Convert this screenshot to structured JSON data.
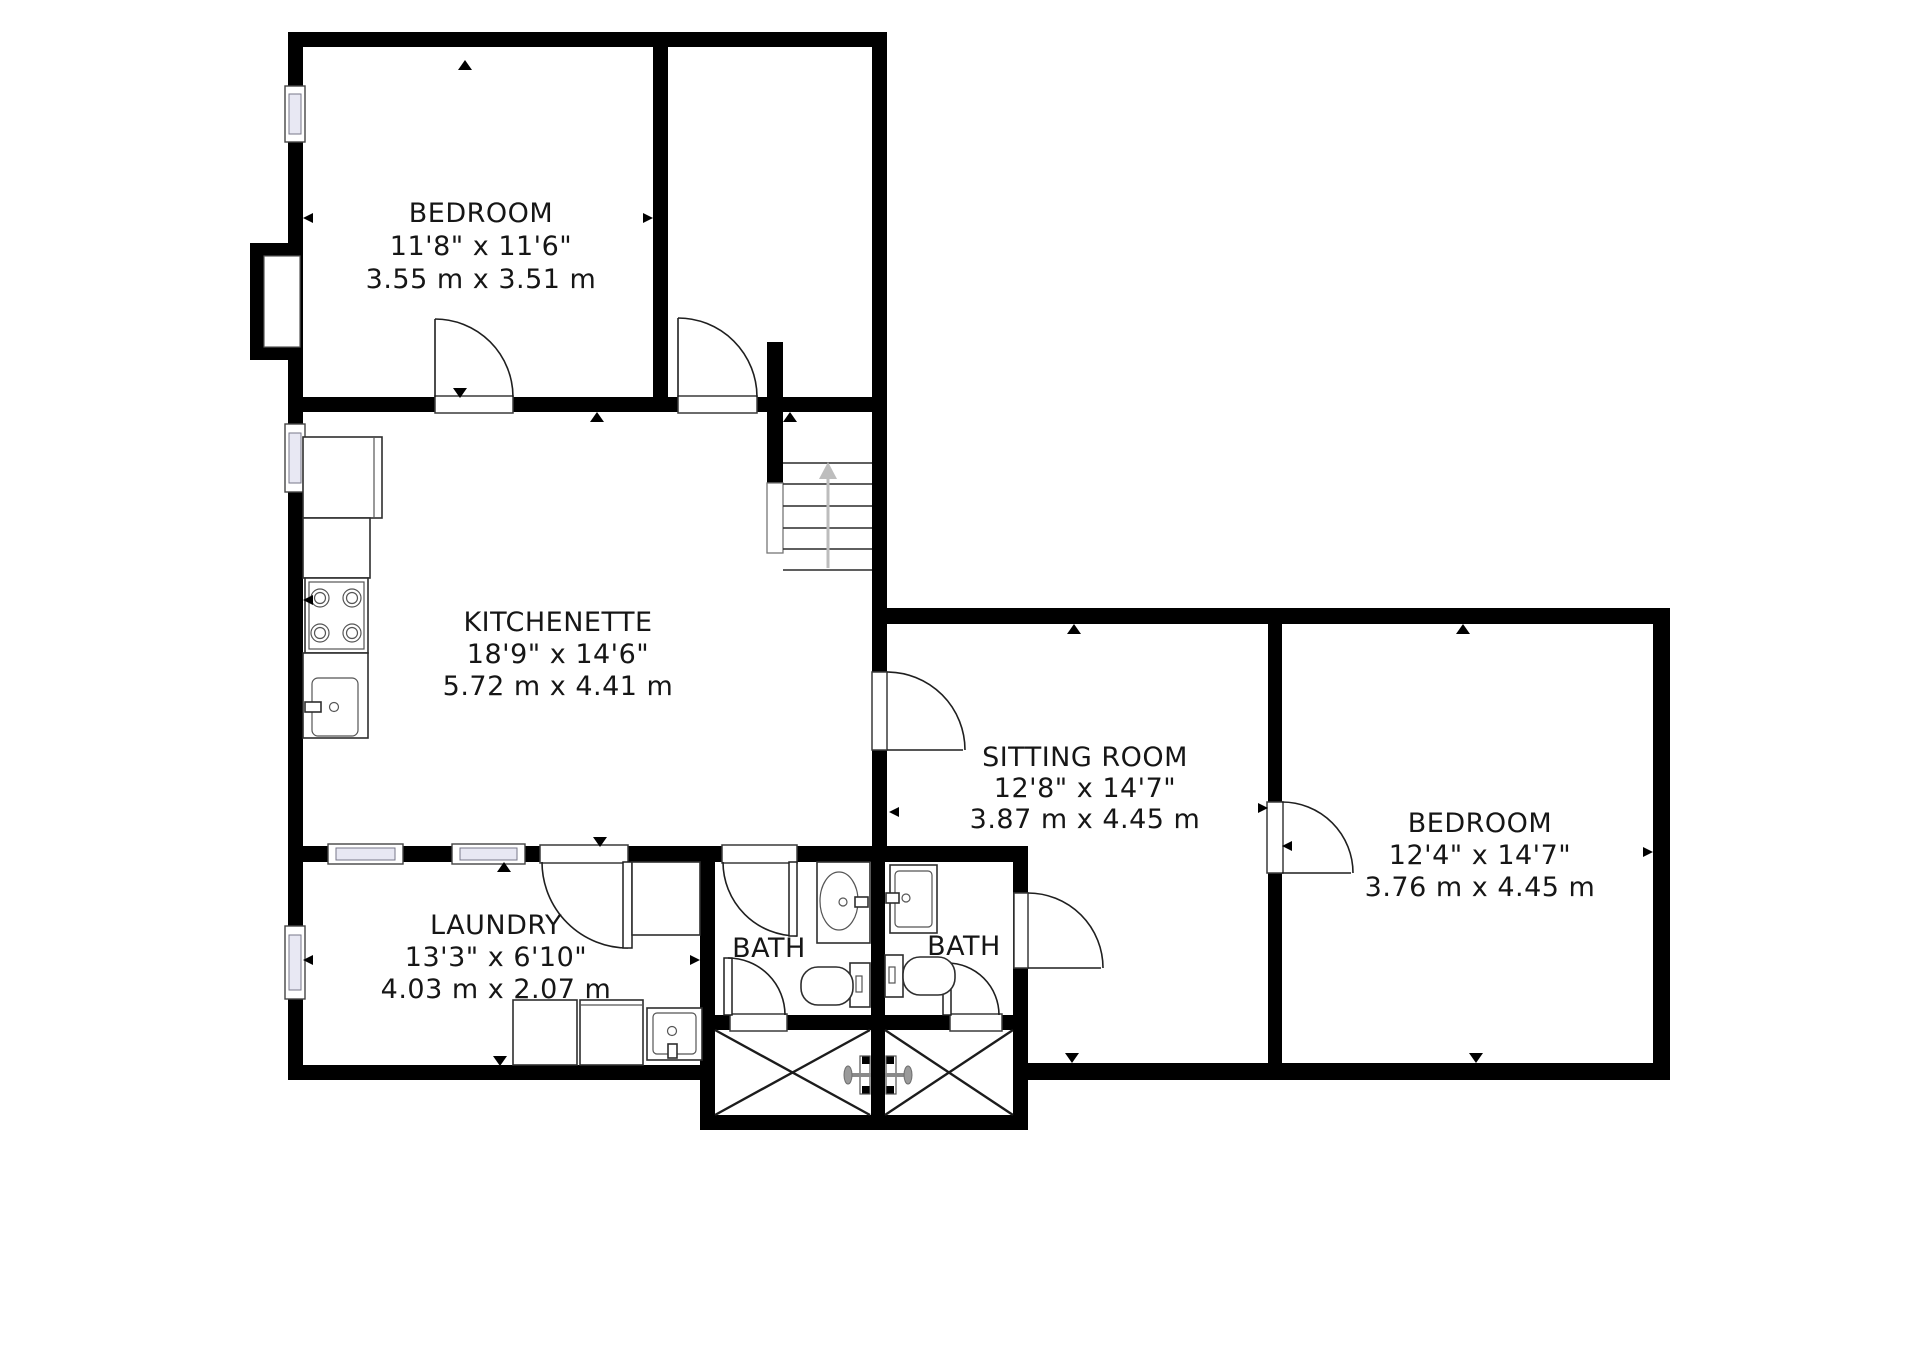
{
  "plan": {
    "type": "floor-plan",
    "background_color": "#ffffff",
    "wall_color": "#000000",
    "window_tint_color": "#e8e8f3",
    "stair_arrow_color": "#bdbdbd",
    "rooms": [
      {
        "id": "bedroom-1",
        "name": "BEDROOM",
        "size_imperial": "11'8\" x 11'6\"",
        "size_metric": "3.55 m x 3.51 m"
      },
      {
        "id": "kitchenette",
        "name": "KITCHENETTE",
        "size_imperial": "18'9\" x 14'6\"",
        "size_metric": "5.72 m x 4.41 m"
      },
      {
        "id": "sitting-room",
        "name": "SITTING ROOM",
        "size_imperial": "12'8\" x 14'7\"",
        "size_metric": "3.87 m x 4.45 m"
      },
      {
        "id": "bedroom-2",
        "name": "BEDROOM",
        "size_imperial": "12'4\" x 14'7\"",
        "size_metric": "3.76 m x 4.45 m"
      },
      {
        "id": "laundry",
        "name": "LAUNDRY",
        "size_imperial": "13'3\" x 6'10\"",
        "size_metric": "4.03 m x 2.07 m"
      },
      {
        "id": "bath-1",
        "name": "BATH"
      },
      {
        "id": "bath-2",
        "name": "BATH"
      }
    ],
    "stairs": {
      "direction": "up"
    },
    "fixtures": [
      "stove",
      "kitchen-sink",
      "refrigerator",
      "washer",
      "washer",
      "laundry-sink",
      "water-heater",
      "vanity-sink",
      "toilet",
      "vanity-sink",
      "toilet",
      "shower",
      "shower"
    ]
  }
}
